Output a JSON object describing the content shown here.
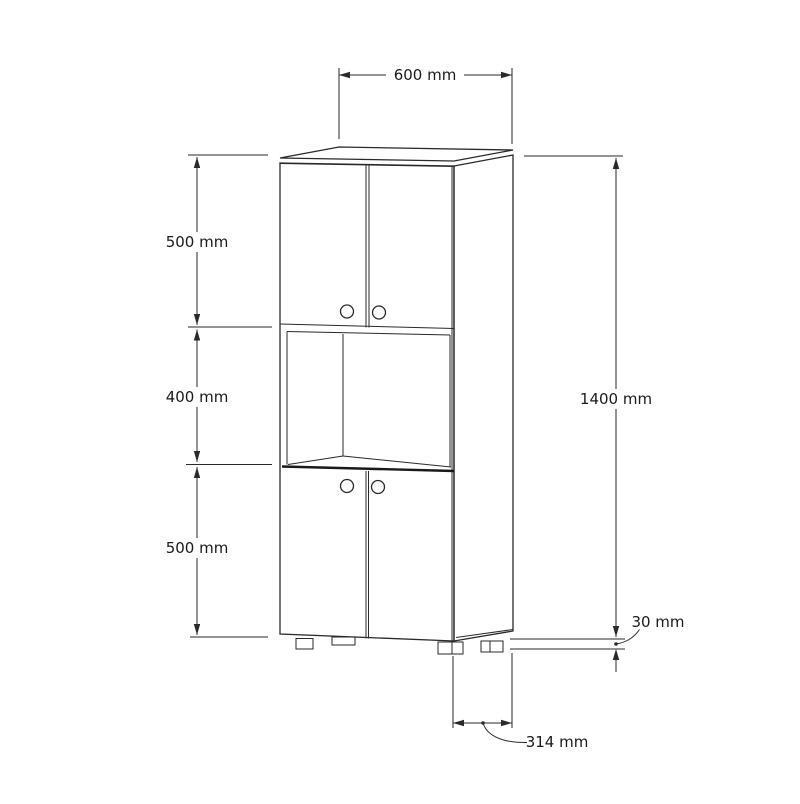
{
  "page": {
    "background": "#ffffff",
    "line_color": "#2a2a2a",
    "text_color": "#1a1a1a"
  },
  "drawing": {
    "kind": "furniture-technical-drawing",
    "dims": {
      "width": "600 mm",
      "upper": "500 mm",
      "middle": "400 mm",
      "lower": "500 mm",
      "total": "1400 mm",
      "leg": "30 mm",
      "depth": "314 mm"
    }
  }
}
